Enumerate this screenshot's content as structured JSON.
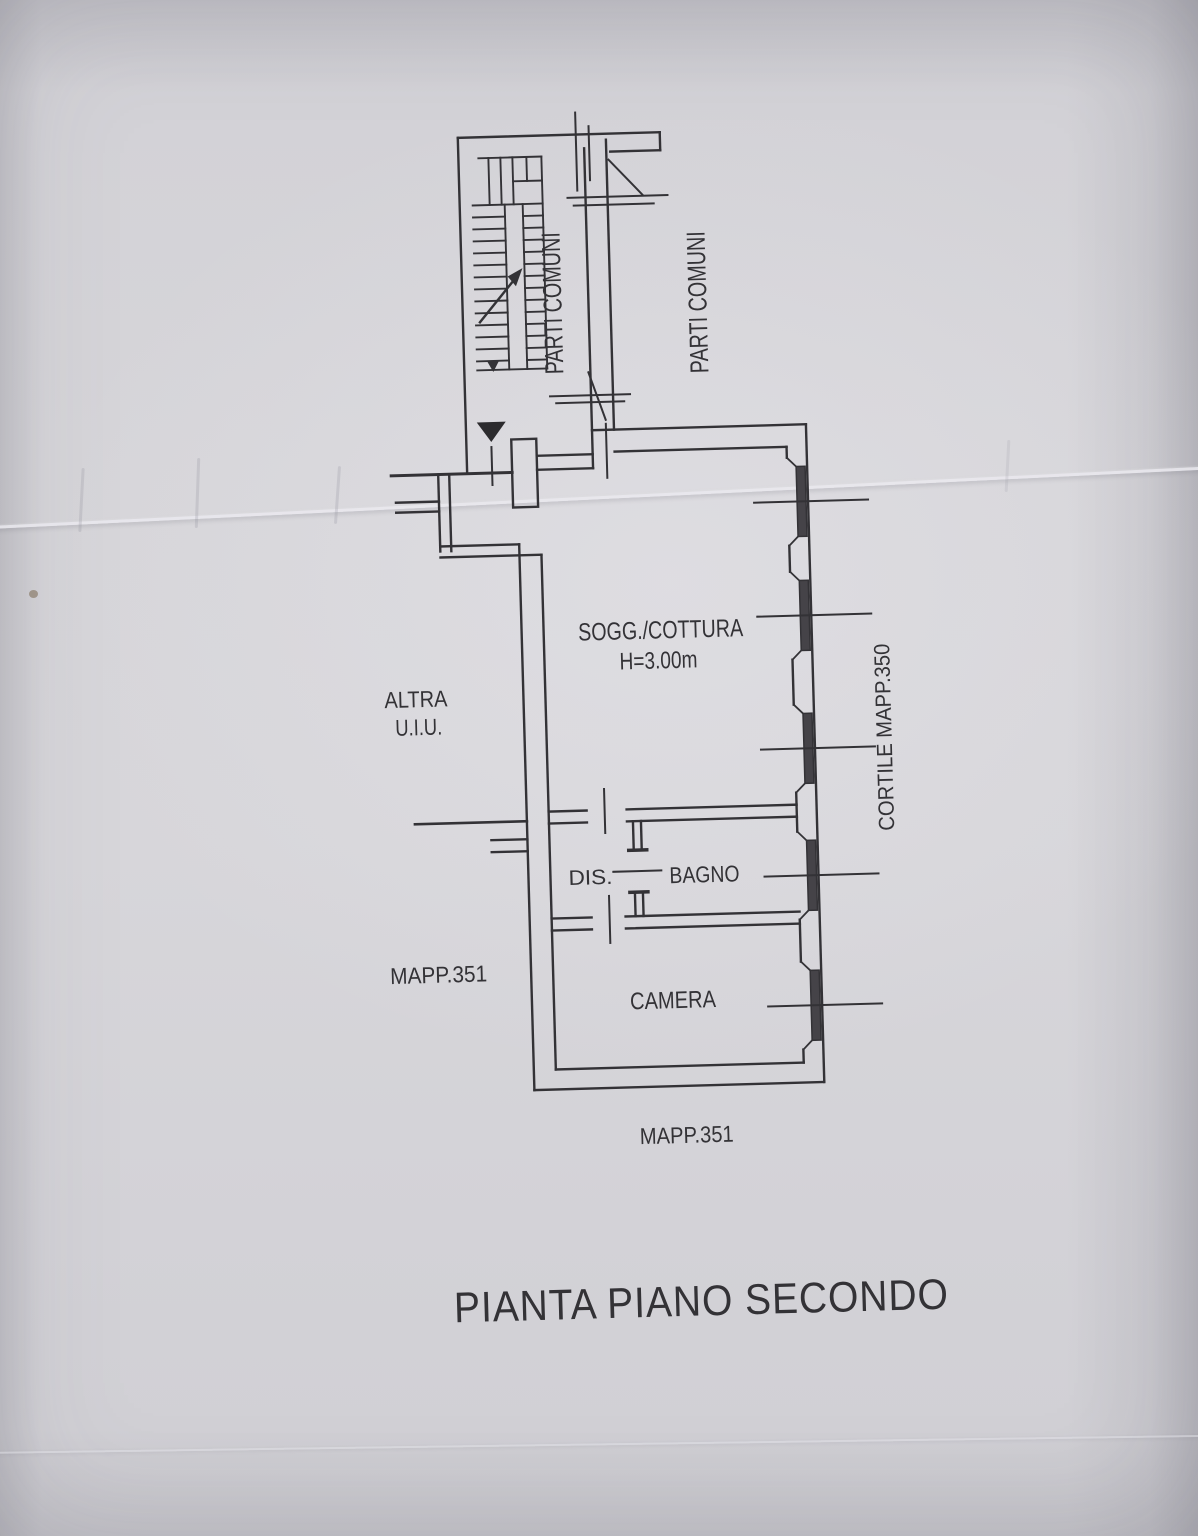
{
  "title": "PIANTA PIANO SECONDO",
  "labels": {
    "stairwell_common": "PARTI COMUNI",
    "landing_common": "PARTI COMUNI",
    "other_unit_line1": "ALTRA",
    "other_unit_line2": "U.I.U.",
    "parcel_left": "MAPP.351",
    "parcel_bottom": "MAPP.351",
    "courtyard_parcel": "CORTILE MAPP.350"
  },
  "rooms": {
    "living_kitchen": "SOGG./COTTURA",
    "living_kitchen_height": "H=3.00m",
    "hallway": "DIS.",
    "bathroom": "BAGNO",
    "bedroom": "CAMERA"
  },
  "colors": {
    "paper": "#d4d3d7",
    "ink": "#333236"
  }
}
